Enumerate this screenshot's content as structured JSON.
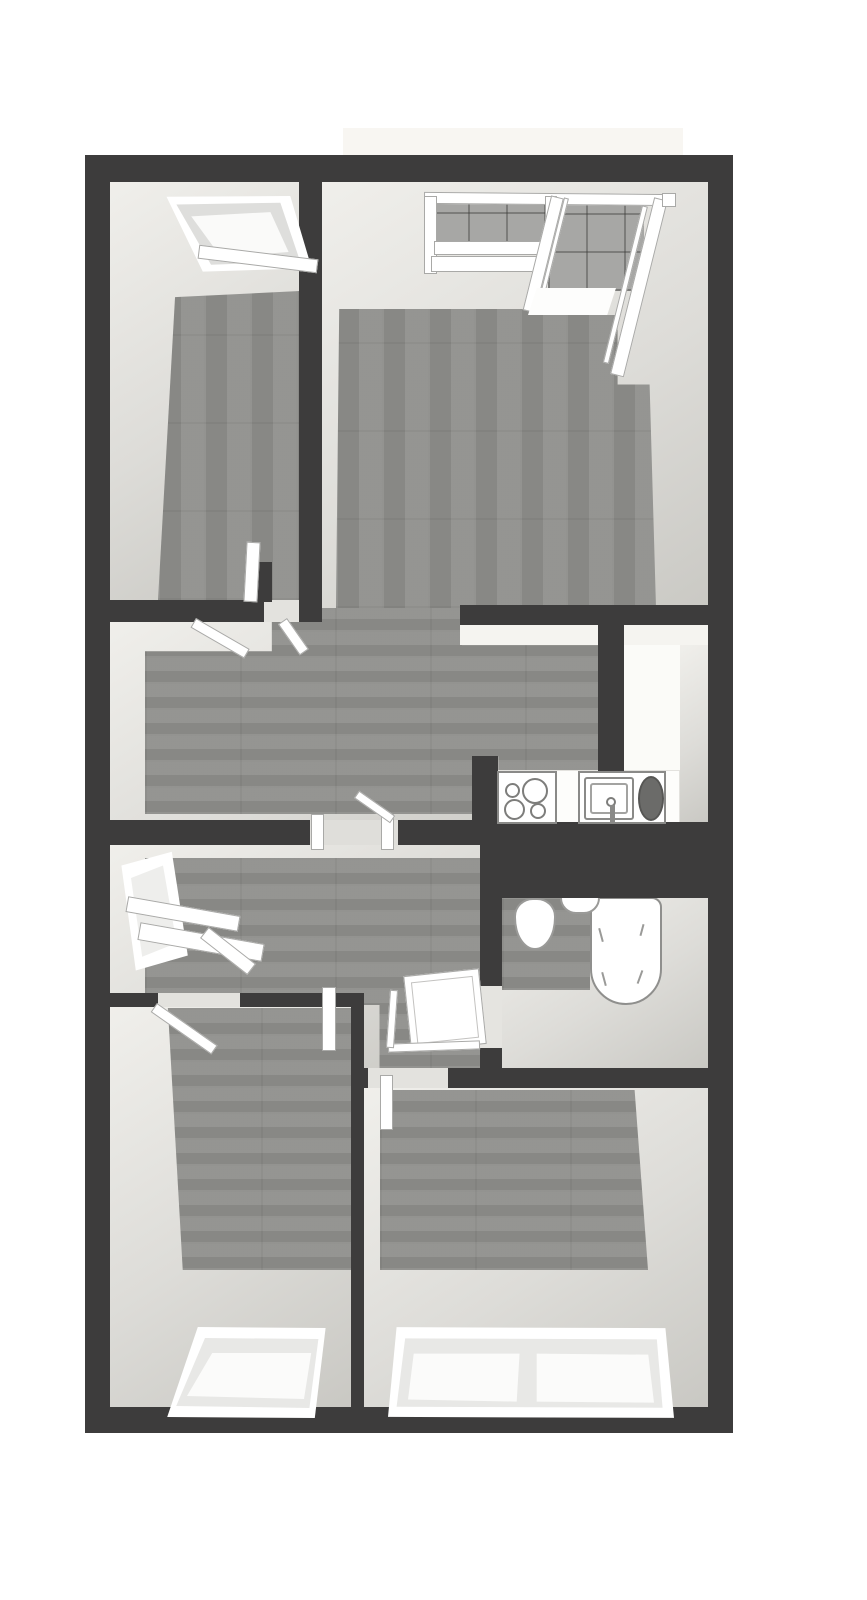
{
  "meta": {
    "width": 867,
    "height": 1600,
    "background": "#ffffff",
    "kind": "3d-floorplan-render"
  },
  "palette": {
    "wall": "#3d3c3c",
    "face_light": "#f0efeb",
    "face_mid": "#dddcd8",
    "face_dark": "#c9c8c3",
    "wood": "#8f8f8c",
    "tile": "#a7a7a5",
    "frame_line": "#a9a9a7",
    "burner_line": "#7d7d7b",
    "appliance_dark": "#6b6b69",
    "white": "#ffffff"
  },
  "rooms": [
    {
      "id": "room-a",
      "label": "top-left bedroom"
    },
    {
      "id": "living-room",
      "label": "top-right living room with corner windows"
    },
    {
      "id": "hall",
      "label": "central hall"
    },
    {
      "id": "kitchen",
      "label": "kitchen with cooktop and sink"
    },
    {
      "id": "entry",
      "label": "entry with window bench"
    },
    {
      "id": "bathroom",
      "label": "bathroom with toilet and bathtub"
    },
    {
      "id": "bedroom1",
      "label": "bottom-left bedroom"
    },
    {
      "id": "bedroom2",
      "label": "bottom-right bedroom"
    }
  ],
  "plan": {
    "elements": [
      {
        "n": "balcony-slab",
        "c": "fill",
        "x": 343,
        "y": 128,
        "w": 340,
        "h": 29,
        "f": "#f8f6f2"
      },
      {
        "n": "room-a-interior",
        "c": "face",
        "x": 108,
        "y": 180,
        "w": 192,
        "h": 420
      },
      {
        "n": "living-room-interior",
        "c": "face",
        "x": 322,
        "y": 180,
        "w": 388,
        "h": 445
      },
      {
        "n": "hall-interior",
        "c": "face",
        "x": 108,
        "y": 622,
        "w": 492,
        "h": 200
      },
      {
        "n": "kitchen-interior",
        "c": "fill",
        "x": 598,
        "y": 625,
        "w": 112,
        "h": 200,
        "f": "#fbfbf8"
      },
      {
        "n": "entry-interior",
        "c": "face",
        "x": 108,
        "y": 845,
        "w": 374,
        "h": 225
      },
      {
        "n": "bathroom-interior",
        "c": "face",
        "x": 502,
        "y": 898,
        "w": 208,
        "h": 172
      },
      {
        "n": "bedroom1-interior",
        "c": "face",
        "x": 108,
        "y": 1007,
        "w": 245,
        "h": 401
      },
      {
        "n": "bedroom2-interior",
        "c": "face",
        "x": 364,
        "y": 1088,
        "w": 346,
        "h": 320
      },
      {
        "n": "balcony-tile-wall-left",
        "c": "tile",
        "x": 430,
        "y": 200,
        "w": 214,
        "h": 52
      },
      {
        "n": "balcony-tile-wall-right",
        "c": "tile",
        "x": 548,
        "y": 203,
        "w": 96,
        "h": 88
      },
      {
        "n": "room-a-floor",
        "c": "wv",
        "x": 158,
        "y": 291,
        "w": 142,
        "h": 309,
        "clip": "polygon(12% 2%, 100% 0%, 100% 100%, 0% 100%)"
      },
      {
        "n": "living-room-floor",
        "c": "wv",
        "x": 336,
        "y": 306,
        "w": 320,
        "h": 302,
        "clip": "polygon(1% 1%, 61% 1%, 61% 3%, 88% 3%, 88% 26%, 98% 26%, 100% 100%, 0% 100%)"
      },
      {
        "n": "hall-floor",
        "c": "wh",
        "x": 145,
        "y": 608,
        "w": 453,
        "h": 206,
        "clip": "polygon(28% 0%, 70% 0%, 70% 18%, 100% 18%, 100% 80%, 78% 80%, 78% 72%, 73% 72%, 73% 100%, 0% 100%, 0% 21%, 28% 21%)"
      },
      {
        "n": "entry-floor",
        "c": "wh",
        "x": 145,
        "y": 858,
        "w": 335,
        "h": 210,
        "clip": "polygon(0% 0%, 100% 0%, 100% 100%, 70% 100%, 70% 70%, 0% 70%)"
      },
      {
        "n": "bathroom-floor-patch",
        "c": "wh",
        "x": 502,
        "y": 898,
        "w": 88,
        "h": 92
      },
      {
        "n": "bedroom1-floor",
        "c": "wh",
        "x": 166,
        "y": 1008,
        "w": 186,
        "h": 262,
        "clip": "polygon(1% 0%, 100% 0%, 100% 100%, 9% 100%)"
      },
      {
        "n": "bedroom2-floor",
        "c": "wh",
        "x": 380,
        "y": 1090,
        "w": 268,
        "h": 180,
        "clip": "polygon(0% 0%, 95% 0%, 100% 100%, 0% 100%)"
      },
      {
        "n": "kitchen-north-face",
        "c": "fill",
        "x": 460,
        "y": 625,
        "w": 248,
        "h": 20,
        "f": "#f5f4f0"
      },
      {
        "n": "kitchen-east-face",
        "c": "face",
        "x": 680,
        "y": 645,
        "w": 30,
        "h": 180
      },
      {
        "n": "kitchen-west-face",
        "c": "fill",
        "x": 598,
        "y": 772,
        "w": 27,
        "h": 53,
        "f": "#efeeea"
      },
      {
        "n": "kitchen-counter",
        "c": "fill",
        "x": 488,
        "y": 770,
        "w": 192,
        "h": 55,
        "f": "#fdfdfb",
        "b": "1px solid #e3e2de"
      },
      {
        "n": "bathtub",
        "c": "fill",
        "x": 590,
        "y": 897,
        "w": 72,
        "h": 108,
        "f": "#ffffff",
        "b": "2px solid #8f8f8d",
        "r": "10px 10px 36px 36px"
      },
      {
        "n": "bathtub-mark",
        "c": "fill",
        "x": 600,
        "y": 928,
        "w": 2,
        "h": 14,
        "f": "#9a9a98",
        "rot": -15
      },
      {
        "n": "bathtub-mark",
        "c": "fill",
        "x": 641,
        "y": 924,
        "w": 2,
        "h": 12,
        "f": "#9a9a98",
        "rot": 15
      },
      {
        "n": "bathtub-mark",
        "c": "fill",
        "x": 603,
        "y": 972,
        "w": 2,
        "h": 14,
        "f": "#9a9a98",
        "rot": -15
      },
      {
        "n": "bathtub-mark",
        "c": "fill",
        "x": 639,
        "y": 970,
        "w": 2,
        "h": 14,
        "f": "#9a9a98",
        "rot": 20
      },
      {
        "n": "toilet",
        "c": "fill",
        "x": 514,
        "y": 898,
        "w": 42,
        "h": 52,
        "f": "#ffffff",
        "b": "2px solid #9a9a98",
        "r": "45% 45% 50% 50% / 35% 35% 62% 62%"
      },
      {
        "n": "bathroom-sink",
        "c": "fill",
        "x": 560,
        "y": 896,
        "w": 40,
        "h": 18,
        "f": "#ffffff",
        "b": "2px solid #9a9a98",
        "r": "0 0 16px 16px"
      },
      {
        "n": "wall-outer-top",
        "c": "wall",
        "x": 85,
        "y": 155,
        "w": 648,
        "h": 27
      },
      {
        "n": "wall-outer-left",
        "c": "wall",
        "x": 85,
        "y": 155,
        "w": 25,
        "h": 1278
      },
      {
        "n": "wall-outer-right",
        "c": "wall",
        "x": 708,
        "y": 155,
        "w": 25,
        "h": 1278
      },
      {
        "n": "wall-outer-bottom",
        "c": "wall",
        "x": 85,
        "y": 1407,
        "w": 648,
        "h": 26
      },
      {
        "n": "wall-room-a-east",
        "c": "wall",
        "x": 299,
        "y": 180,
        "w": 23,
        "h": 442
      },
      {
        "n": "wall-room-a-south",
        "c": "wall",
        "x": 108,
        "y": 600,
        "w": 156,
        "h": 22
      },
      {
        "n": "room-a-door-gap",
        "c": "fill",
        "x": 264,
        "y": 600,
        "w": 35,
        "h": 22,
        "f": "#e3e2de"
      },
      {
        "n": "wall-room-a-door-stub",
        "c": "wall",
        "x": 252,
        "y": 562,
        "w": 20,
        "h": 40
      },
      {
        "n": "wall-kitchen-north",
        "c": "wall",
        "x": 460,
        "y": 605,
        "w": 248,
        "h": 20
      },
      {
        "n": "wall-kitchen-west",
        "c": "wall",
        "x": 598,
        "y": 625,
        "w": 26,
        "h": 147
      },
      {
        "n": "wall-hall-south-west",
        "c": "wall",
        "x": 108,
        "y": 820,
        "w": 202,
        "h": 25
      },
      {
        "n": "hall-door-gap",
        "c": "fill",
        "x": 310,
        "y": 820,
        "w": 88,
        "h": 25,
        "f": "#dfdeda"
      },
      {
        "n": "wall-hall-south-east",
        "c": "wall",
        "x": 398,
        "y": 820,
        "w": 84,
        "h": 25
      },
      {
        "n": "wall-shaft",
        "c": "wall",
        "x": 480,
        "y": 822,
        "w": 253,
        "h": 76
      },
      {
        "n": "wall-bathroom-west-upper",
        "c": "wall",
        "x": 480,
        "y": 898,
        "w": 22,
        "h": 88
      },
      {
        "n": "bathroom-door-gap",
        "c": "fill",
        "x": 480,
        "y": 986,
        "w": 22,
        "h": 62,
        "f": "#e5e4e0"
      },
      {
        "n": "wall-bathroom-west-lower",
        "c": "wall",
        "x": 480,
        "y": 1048,
        "w": 22,
        "h": 22
      },
      {
        "n": "wall-entry-south-west",
        "c": "wall",
        "x": 108,
        "y": 993,
        "w": 50,
        "h": 14
      },
      {
        "n": "entry-door-gap",
        "c": "fill",
        "x": 158,
        "y": 993,
        "w": 82,
        "h": 14,
        "f": "#e3e2de"
      },
      {
        "n": "wall-entry-south-east",
        "c": "wall",
        "x": 240,
        "y": 993,
        "w": 113,
        "h": 14
      },
      {
        "n": "wall-bedrooms-divider",
        "c": "wall",
        "x": 351,
        "y": 993,
        "w": 13,
        "h": 415
      },
      {
        "n": "wall-bedroom2-north-west",
        "c": "wall",
        "x": 351,
        "y": 1068,
        "w": 17,
        "h": 20
      },
      {
        "n": "bedroom2-door-gap",
        "c": "fill",
        "x": 368,
        "y": 1068,
        "w": 80,
        "h": 20,
        "f": "#e3e2de"
      },
      {
        "n": "wall-bedroom2-north-east",
        "c": "wall",
        "x": 448,
        "y": 1068,
        "w": 285,
        "h": 20
      },
      {
        "n": "wall-kitchen-stub",
        "c": "wall",
        "x": 472,
        "y": 756,
        "w": 26,
        "h": 70
      },
      {
        "n": "room-a-window-frame",
        "c": "poly",
        "x": 150,
        "y": 190,
        "w": 165,
        "h": 85,
        "f": "#ffffff",
        "clip": "polygon(10% 8%, 85% 7%, 98% 92%, 32% 96%)"
      },
      {
        "n": "room-a-window-sash",
        "c": "poly",
        "x": 150,
        "y": 190,
        "w": 165,
        "h": 85,
        "f": "#dededc",
        "clip": "polygon(16% 17%, 79% 15%, 91% 84%, 37% 88%)"
      },
      {
        "n": "room-a-window-pane",
        "c": "poly",
        "x": 150,
        "y": 190,
        "w": 165,
        "h": 85,
        "f": "#fafaf9",
        "clip": "polygon(25% 31%, 73% 26%, 84% 73%, 43% 79%)"
      },
      {
        "n": "room-a-window-sill",
        "c": "white",
        "x": 198,
        "y": 252,
        "w": 120,
        "h": 14,
        "rot": 7
      },
      {
        "n": "living-window-top-rail",
        "c": "white",
        "x": 424,
        "y": 193,
        "w": 250,
        "h": 12,
        "rot": 0.5
      },
      {
        "n": "living-window-left-jamb",
        "c": "white",
        "x": 424,
        "y": 196,
        "w": 13,
        "h": 78
      },
      {
        "n": "living-window-sill-upper",
        "c": "white",
        "x": 434,
        "y": 241,
        "w": 114,
        "h": 14
      },
      {
        "n": "living-window-sill-lower",
        "c": "white",
        "x": 431,
        "y": 256,
        "w": 116,
        "h": 16
      },
      {
        "n": "living-window-mid-post",
        "c": "white",
        "x": 545,
        "y": 196,
        "w": 12,
        "h": 52
      },
      {
        "n": "living-corner-window-glass-1",
        "c": "white",
        "x": 564,
        "y": 198,
        "w": 5,
        "h": 112,
        "rot": 14,
        "o": "50% 0%"
      },
      {
        "n": "living-corner-window-pane-1",
        "c": "white",
        "x": 551,
        "y": 197,
        "w": 13,
        "h": 118,
        "rot": 14,
        "o": "50% 0%"
      },
      {
        "n": "living-corner-window-sill",
        "c": "poly",
        "x": 528,
        "y": 288,
        "w": 88,
        "h": 27,
        "f": "#fdfdfc",
        "clip": "polygon(10% 0%, 100% 0%, 90% 100%, 0% 100%)"
      },
      {
        "n": "living-corner-window-glass-2",
        "c": "white",
        "x": 642,
        "y": 206,
        "w": 6,
        "h": 162,
        "rot": 14,
        "o": "50% 0%"
      },
      {
        "n": "living-corner-window-pane-2",
        "c": "white",
        "x": 654,
        "y": 199,
        "w": 14,
        "h": 182,
        "rot": 14,
        "o": "50% 0%"
      },
      {
        "n": "living-window-right-cap",
        "c": "white",
        "x": 662,
        "y": 193,
        "w": 14,
        "h": 14
      },
      {
        "n": "entry-window-frame",
        "c": "poly",
        "x": 115,
        "y": 848,
        "w": 80,
        "h": 125,
        "f": "#ffffff",
        "clip": "polygon(8% 14%, 71% 3%, 91% 86%, 26% 98%)"
      },
      {
        "n": "entry-window-pane",
        "c": "poly",
        "x": 115,
        "y": 848,
        "w": 80,
        "h": 125,
        "f": "#eeeeec",
        "clip": "polygon(20% 24%, 60% 14%, 77% 76%, 34% 87%)"
      },
      {
        "n": "entry-bench-top",
        "c": "white",
        "x": 126,
        "y": 906,
        "w": 114,
        "h": 16,
        "rot": 10
      },
      {
        "n": "entry-bench-front",
        "c": "white",
        "x": 138,
        "y": 933,
        "w": 126,
        "h": 18,
        "rot": 10
      },
      {
        "n": "entry-bench-return",
        "c": "white",
        "x": 198,
        "y": 944,
        "w": 60,
        "h": 14,
        "rot": 38
      },
      {
        "n": "bedroom1-window-frame",
        "c": "poly",
        "x": 160,
        "y": 1322,
        "w": 180,
        "h": 100,
        "f": "#ffffff",
        "clip": "polygon(21% 5%, 92% 6%, 86% 96%, 4% 95%)"
      },
      {
        "n": "bedroom1-window-sash",
        "c": "poly",
        "x": 160,
        "y": 1322,
        "w": 180,
        "h": 100,
        "f": "#e8e8e6",
        "clip": "polygon(25% 16%, 88% 17%, 83% 86%, 9% 84%)"
      },
      {
        "n": "bedroom1-window-pane",
        "c": "poly",
        "x": 160,
        "y": 1322,
        "w": 180,
        "h": 100,
        "f": "#fbfbfa",
        "clip": "polygon(29% 31%, 84% 31%, 80% 77%, 15% 74%)"
      },
      {
        "n": "bedroom2-window-frame",
        "c": "poly",
        "x": 388,
        "y": 1320,
        "w": 286,
        "h": 102,
        "f": "#ffffff",
        "clip": "polygon(3% 7%, 97% 8%, 100% 96%, 0% 95%)"
      },
      {
        "n": "bedroom2-window-sash",
        "c": "poly",
        "x": 388,
        "y": 1320,
        "w": 286,
        "h": 102,
        "f": "#e8e8e6",
        "clip": "polygon(6% 18%, 94% 19%, 96% 86%, 3% 85%)"
      },
      {
        "n": "bedroom2-window-pane-left",
        "c": "poly",
        "x": 388,
        "y": 1320,
        "w": 286,
        "h": 102,
        "f": "#fbfbfa",
        "clip": "polygon(9% 33%, 46% 33%, 45% 80%, 7% 78%)"
      },
      {
        "n": "bedroom2-window-pane-right",
        "c": "poly",
        "x": 388,
        "y": 1320,
        "w": 286,
        "h": 102,
        "f": "#fbfbfa",
        "clip": "polygon(52% 33%, 91% 34%, 93% 81%, 52% 80%)"
      },
      {
        "n": "room-a-door",
        "c": "white",
        "x": 245,
        "y": 542,
        "w": 14,
        "h": 60,
        "rot": 3
      },
      {
        "n": "room-a-door-swing-left",
        "c": "white",
        "x": 196,
        "y": 618,
        "w": 62,
        "h": 11,
        "rot": 30,
        "o": "0% 0%"
      },
      {
        "n": "room-a-door-swing-right",
        "c": "white",
        "x": 287,
        "y": 618,
        "w": 38,
        "h": 11,
        "rot": 55,
        "o": "0% 0%"
      },
      {
        "n": "hall-door-jamb-left",
        "c": "white",
        "x": 311,
        "y": 814,
        "w": 13,
        "h": 36
      },
      {
        "n": "hall-door-jamb-right",
        "c": "white",
        "x": 381,
        "y": 814,
        "w": 13,
        "h": 36
      },
      {
        "n": "hall-door-swing",
        "c": "white",
        "x": 354,
        "y": 789,
        "w": 44,
        "h": 9,
        "rot": 35,
        "o": "0% 100%"
      },
      {
        "n": "bathroom-door",
        "c": "white",
        "x": 407,
        "y": 972,
        "w": 76,
        "h": 76,
        "rot": -6
      },
      {
        "n": "bathroom-door-panel-line",
        "c": "fill",
        "x": 414,
        "y": 979,
        "w": 62,
        "h": 62,
        "f": "none",
        "b": "1px solid #c3c2c0",
        "rot": -6
      },
      {
        "n": "bathroom-door-edge-bottom",
        "c": "white",
        "x": 388,
        "y": 1042,
        "w": 92,
        "h": 9,
        "rot": -2
      },
      {
        "n": "bathroom-door-edge-left",
        "c": "white",
        "x": 388,
        "y": 990,
        "w": 8,
        "h": 58,
        "rot": 4
      },
      {
        "n": "vestibule-door",
        "c": "white",
        "x": 322,
        "y": 987,
        "w": 14,
        "h": 64
      },
      {
        "n": "bedroom2-door",
        "c": "white",
        "x": 380,
        "y": 1075,
        "w": 13,
        "h": 55
      },
      {
        "n": "bedroom1-door",
        "c": "white",
        "x": 157,
        "y": 1003,
        "w": 74,
        "h": 11,
        "rot": 35,
        "o": "0% 0%"
      },
      {
        "n": "cooktop",
        "c": "fill",
        "x": 497,
        "y": 771,
        "w": 60,
        "h": 53,
        "f": "#ffffff",
        "b": "2px solid #8a8a88"
      },
      {
        "n": "cooktop-burner-small-1",
        "c": "circle",
        "x": 505,
        "y": 783,
        "w": 15,
        "h": 15
      },
      {
        "n": "cooktop-burner-large-1",
        "c": "circle",
        "x": 522,
        "y": 778,
        "w": 26,
        "h": 26
      },
      {
        "n": "cooktop-burner-large-2",
        "c": "circle",
        "x": 504,
        "y": 799,
        "w": 21,
        "h": 21
      },
      {
        "n": "cooktop-burner-small-2",
        "c": "circle",
        "x": 530,
        "y": 803,
        "w": 16,
        "h": 16
      },
      {
        "n": "kitchen-sink-unit",
        "c": "fill",
        "x": 578,
        "y": 771,
        "w": 88,
        "h": 53,
        "f": "#ffffff",
        "b": "2px solid #8a8a88"
      },
      {
        "n": "sink-basin-outer",
        "c": "fill",
        "x": 584,
        "y": 777,
        "w": 50,
        "h": 43,
        "f": "none",
        "b": "2px solid #8a8a88",
        "r": "3px"
      },
      {
        "n": "sink-basin-inner",
        "c": "fill",
        "x": 590,
        "y": 783,
        "w": 38,
        "h": 31,
        "f": "none",
        "b": "2px solid #a3a3a1",
        "r": "3px"
      },
      {
        "n": "sink-faucet-knob",
        "c": "circle",
        "x": 606,
        "y": 797,
        "w": 10,
        "h": 10
      },
      {
        "n": "sink-faucet-stem",
        "c": "fill",
        "x": 610,
        "y": 805,
        "w": 5,
        "h": 18,
        "f": "#8a8a88"
      },
      {
        "n": "sink-drainer",
        "c": "oval",
        "x": 638,
        "y": 776,
        "w": 26,
        "h": 45,
        "f": "#6b6b69",
        "b": "2px solid #565654"
      }
    ]
  }
}
